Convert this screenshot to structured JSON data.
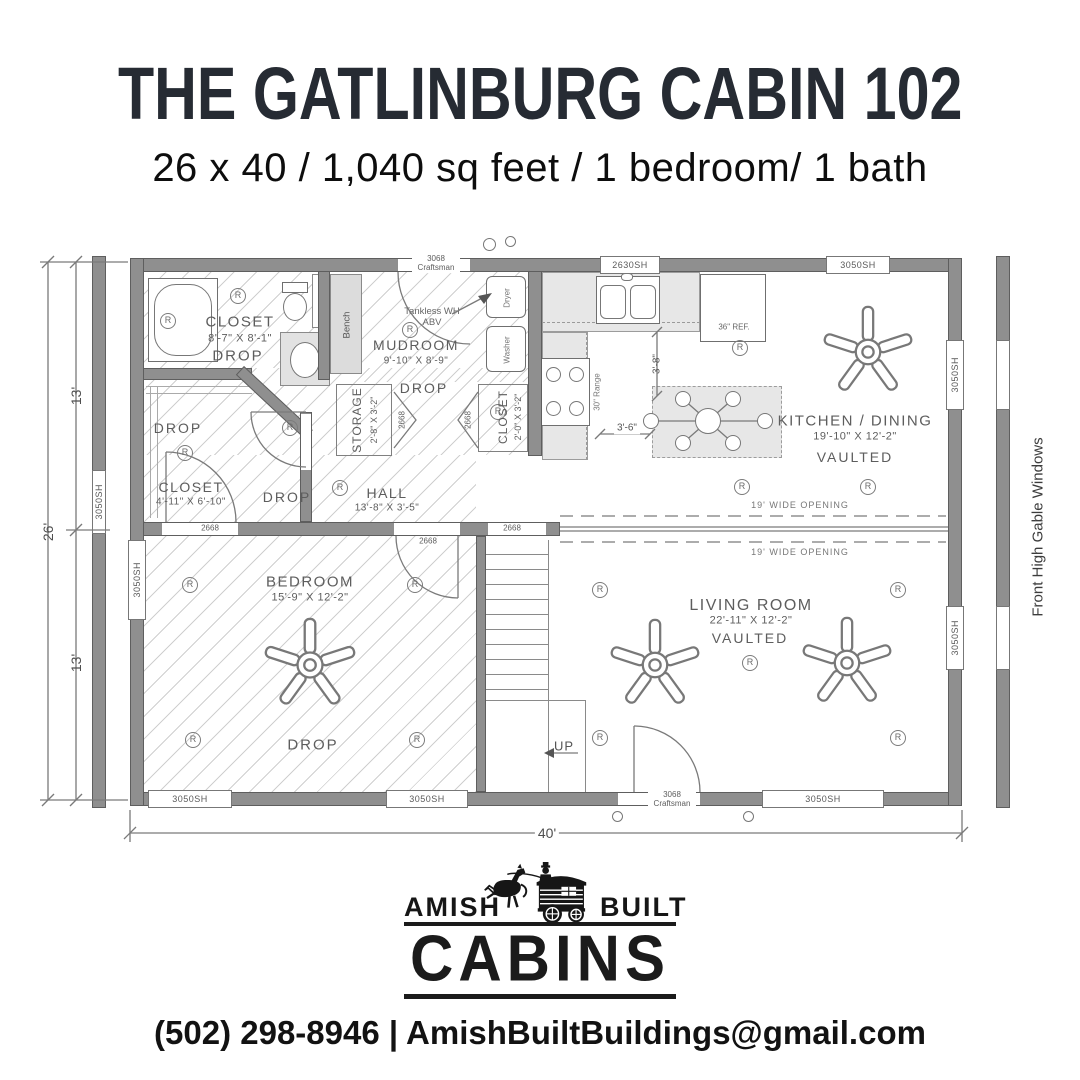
{
  "header": {
    "title": "THE GATLINBURG CABIN 102",
    "subtitle": "26 x 40 / 1,040 sq feet / 1 bedroom/ 1 bath"
  },
  "plan": {
    "rooms": {
      "bath": {
        "name": "CLOSET",
        "dims": "8'-7\" X 8'-1\"",
        "ceiling": "DROP"
      },
      "mudroom": {
        "name": "MUDROOM",
        "dims": "9'-10\" X 8'-9\"",
        "ceiling": "DROP"
      },
      "storage": {
        "name": "STORAGE",
        "dims": "2'-8\" X 3'-2\""
      },
      "mud_closet": {
        "name": "CLOSET",
        "dims": "2'-0\" X 3'-2\""
      },
      "bedroom_closet": {
        "name": "CLOSET",
        "dims": "4'-11\" X 6'-10\"",
        "ceiling": "DROP"
      },
      "hall": {
        "name": "HALL",
        "dims": "13'-8\" X 3'-5\"",
        "ceiling": "DROP"
      },
      "bedroom": {
        "name": "BEDROOM",
        "dims": "15'-9\" X 12'-2\"",
        "ceiling": "DROP"
      },
      "kitchen": {
        "name": "KITCHEN / DINING",
        "dims": "19'-10\" X 12'-2\"",
        "ceiling": "VAULTED"
      },
      "living": {
        "name": "LIVING ROOM",
        "dims": "22'-11\" X 12'-2\"",
        "ceiling": "VAULTED"
      }
    },
    "fixtures": {
      "bench": "Bench",
      "tankless": "Tankless WH ABV",
      "washer": "Washer",
      "dryer": "Dryer",
      "fridge": "36\" REF.",
      "range": "30\" Range",
      "up": "UP"
    },
    "labels": {
      "window_3050": "3050SH",
      "window_2630": "2630SH",
      "door_2668": "2668",
      "door_3068": "3068 Craftsman",
      "opening": "19' WIDE OPENING",
      "recessed": "R"
    },
    "dimensions": {
      "width_total": "26'",
      "width_top": "13'",
      "width_bottom": "13'",
      "length_total": "40'",
      "island_gap": "3'-6\"",
      "counter_gap": "3'-8\""
    },
    "note_right": "Front High Gable Windows"
  },
  "logo": {
    "left": "AMISH",
    "right": "BUILT",
    "main": "CABINS"
  },
  "footer": {
    "contact": "(502) 298-8946 | AmishBuiltBuildings@gmail.com"
  }
}
